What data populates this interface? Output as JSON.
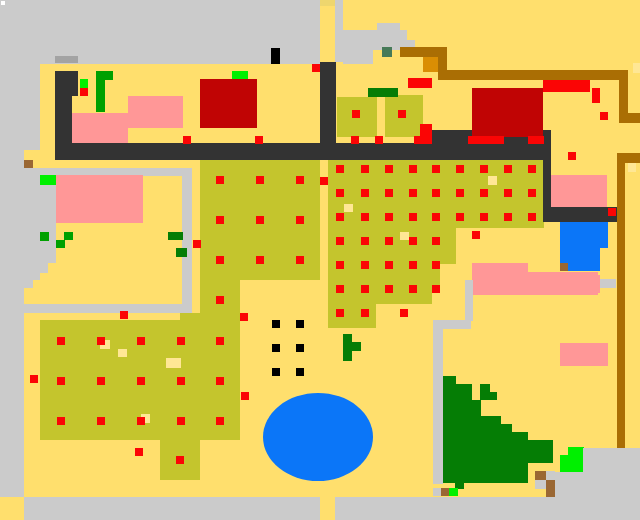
{
  "scene": {
    "label": "pixel-art overhead farm map",
    "width": 640,
    "height": 520
  },
  "palette": {
    "bg": "#ffdf6d",
    "plaza": "#cbcbcb",
    "btn": "#a3a3a3",
    "paledull": "#eed66e",
    "palebright": "#ffe795",
    "olive": "#c4c52d",
    "wall": "#333333",
    "red": "#fb0505",
    "darkred": "#c00404",
    "pink": "#ff9797",
    "blue": "#0b76f8",
    "brownline": "#aa6e04",
    "orange": "#da8e04",
    "brown": "#9a6733",
    "teal": "#477a58",
    "lime": "#00f000",
    "green": "#00a000",
    "darkgreen": "#057d05",
    "black": "#000000",
    "white": "#ffffff"
  },
  "shapes": [
    [
      "r",
      "plaza",
      0,
      0,
      320,
      64
    ],
    [
      "r",
      "plaza",
      0,
      64,
      40,
      86
    ],
    [
      "r",
      "plaza",
      0,
      150,
      24,
      347
    ],
    [
      "r",
      "plaza",
      335,
      0,
      8,
      62
    ],
    [
      "r",
      "plaza",
      377,
      23,
      23,
      9
    ],
    [
      "r",
      "plaza",
      343,
      30,
      64,
      10
    ],
    [
      "r",
      "plaza",
      343,
      40,
      72,
      10
    ],
    [
      "r",
      "plaza",
      343,
      50,
      30,
      14
    ],
    [
      "r",
      "paledull",
      320,
      0,
      15,
      6
    ],
    [
      "r",
      "white",
      1,
      1,
      4,
      4
    ],
    [
      "r",
      "btn",
      55,
      56,
      23,
      7
    ],
    [
      "r",
      "black",
      271,
      48,
      9,
      16
    ],
    [
      "r",
      "plaza",
      24,
      168,
      159,
      8
    ],
    [
      "r",
      "plaza",
      182,
      168,
      10,
      145
    ],
    [
      "r",
      "plaza",
      24,
      304,
      168,
      9
    ],
    [
      "r",
      "plaza",
      24,
      175,
      32,
      88
    ],
    [
      "r",
      "plaza",
      24,
      263,
      24,
      10
    ],
    [
      "r",
      "plaza",
      24,
      273,
      16,
      7
    ],
    [
      "r",
      "plaza",
      24,
      280,
      9,
      8
    ],
    [
      "r",
      "olive",
      200,
      160,
      120,
      120
    ],
    [
      "r",
      "olive",
      200,
      280,
      40,
      160
    ],
    [
      "r",
      "olive",
      40,
      320,
      192,
      120
    ],
    [
      "r",
      "olive",
      180,
      313,
      20,
      10
    ],
    [
      "r",
      "olive",
      160,
      440,
      40,
      40
    ],
    [
      "r",
      "olive",
      328,
      160,
      92,
      144
    ],
    [
      "r",
      "olive",
      328,
      304,
      48,
      24
    ],
    [
      "r",
      "olive",
      420,
      160,
      124,
      68
    ],
    [
      "r",
      "olive",
      420,
      228,
      36,
      36
    ],
    [
      "r",
      "olive",
      420,
      264,
      20,
      24
    ],
    [
      "r",
      "olive",
      420,
      288,
      12,
      16
    ],
    [
      "r",
      "olive",
      337,
      97,
      40,
      40
    ],
    [
      "r",
      "olive",
      385,
      95,
      38,
      42
    ],
    [
      "r",
      "darkgreen",
      368,
      88,
      30,
      9
    ],
    [
      "r",
      "wall",
      55,
      71,
      23,
      25
    ],
    [
      "r",
      "wall",
      55,
      96,
      17,
      64
    ],
    [
      "r",
      "wall",
      55,
      143,
      377,
      17
    ],
    [
      "r",
      "wall",
      432,
      130,
      119,
      30
    ],
    [
      "r",
      "wall",
      320,
      62,
      16,
      98
    ],
    [
      "r",
      "wall",
      543,
      160,
      8,
      62
    ],
    [
      "r",
      "wall",
      551,
      207,
      66,
      15
    ],
    [
      "r",
      "darkred",
      200,
      79,
      57,
      49
    ],
    [
      "r",
      "darkred",
      472,
      88,
      71,
      49
    ],
    [
      "r",
      "lime",
      232,
      71,
      16,
      8
    ],
    [
      "r",
      "pink",
      128,
      96,
      55,
      32
    ],
    [
      "r",
      "pink",
      72,
      113,
      56,
      30
    ],
    [
      "r",
      "pink",
      56,
      175,
      87,
      48
    ],
    [
      "r",
      "pink",
      551,
      175,
      56,
      32
    ],
    [
      "r",
      "pink",
      560,
      275,
      40,
      18
    ],
    [
      "r",
      "pink",
      560,
      343,
      48,
      23
    ],
    [
      "r",
      "pink",
      472,
      263,
      56,
      9
    ],
    [
      "r",
      "pink",
      472,
      272,
      126,
      23
    ],
    [
      "r",
      "plaza",
      600,
      279,
      16,
      9
    ],
    [
      "r",
      "brownline",
      400,
      47,
      47,
      10
    ],
    [
      "r",
      "brownline",
      438,
      48,
      9,
      27
    ],
    [
      "r",
      "brownline",
      438,
      70,
      190,
      10
    ],
    [
      "r",
      "brownline",
      619,
      73,
      9,
      50
    ],
    [
      "r",
      "brownline",
      628,
      113,
      12,
      10
    ],
    [
      "r",
      "brownline",
      617,
      153,
      23,
      10
    ],
    [
      "r",
      "brownline",
      617,
      163,
      8,
      285
    ],
    [
      "r",
      "orange",
      423,
      57,
      15,
      15
    ],
    [
      "r",
      "teal",
      382,
      47,
      10,
      10
    ],
    [
      "r",
      "palebright",
      633,
      63,
      7,
      10
    ],
    [
      "r",
      "palebright",
      628,
      163,
      8,
      9
    ],
    [
      "r",
      "lime",
      80,
      79,
      8,
      9
    ],
    [
      "r",
      "green",
      96,
      71,
      17,
      9
    ],
    [
      "r",
      "green",
      96,
      80,
      9,
      24
    ],
    [
      "r",
      "green",
      96,
      103,
      9,
      9
    ],
    [
      "r",
      "lime",
      40,
      175,
      16,
      10
    ],
    [
      "r",
      "green",
      40,
      232,
      9,
      9
    ],
    [
      "r",
      "green",
      64,
      232,
      9,
      8
    ],
    [
      "r",
      "green",
      56,
      240,
      9,
      8
    ],
    [
      "r",
      "darkgreen",
      168,
      232,
      15,
      8
    ],
    [
      "r",
      "darkgreen",
      176,
      248,
      11,
      9
    ],
    [
      "r",
      "brown",
      24,
      160,
      9,
      8
    ],
    [
      "e",
      "blue",
      318,
      437,
      55,
      44
    ],
    [
      "r",
      "blue",
      560,
      222,
      48,
      26
    ],
    [
      "r",
      "blue",
      560,
      248,
      40,
      23
    ],
    [
      "r",
      "brown",
      560,
      263,
      8,
      8
    ],
    [
      "r",
      "darkgreen",
      343,
      334,
      9,
      27
    ],
    [
      "r",
      "darkgreen",
      352,
      342,
      9,
      9
    ],
    [
      "r",
      "darkgreen",
      441,
      376,
      15,
      9
    ],
    [
      "r",
      "darkgreen",
      441,
      384,
      31,
      16
    ],
    [
      "r",
      "darkgreen",
      480,
      384,
      10,
      16
    ],
    [
      "r",
      "darkgreen",
      488,
      392,
      9,
      8
    ],
    [
      "r",
      "darkgreen",
      441,
      400,
      40,
      16
    ],
    [
      "r",
      "darkgreen",
      441,
      416,
      60,
      9
    ],
    [
      "r",
      "darkgreen",
      441,
      424,
      71,
      8
    ],
    [
      "r",
      "darkgreen",
      441,
      432,
      87,
      9
    ],
    [
      "r",
      "darkgreen",
      441,
      440,
      112,
      23
    ],
    [
      "r",
      "darkgreen",
      441,
      463,
      87,
      20
    ],
    [
      "r",
      "darkgreen",
      455,
      480,
      9,
      9
    ],
    [
      "r",
      "lime",
      568,
      447,
      16,
      9
    ],
    [
      "r",
      "lime",
      560,
      455,
      24,
      17
    ],
    [
      "r",
      "plaza",
      583,
      448,
      57,
      26
    ],
    [
      "r",
      "plaza",
      551,
      472,
      89,
      25
    ],
    [
      "r",
      "plaza",
      465,
      280,
      8,
      41
    ],
    [
      "r",
      "plaza",
      433,
      320,
      38,
      9
    ],
    [
      "r",
      "plaza",
      433,
      329,
      10,
      155
    ],
    [
      "r",
      "plaza",
      433,
      488,
      8,
      8
    ],
    [
      "r",
      "brown",
      441,
      488,
      8,
      8
    ],
    [
      "r",
      "lime",
      449,
      488,
      9,
      8
    ],
    [
      "r",
      "brown",
      535,
      471,
      12,
      9
    ],
    [
      "r",
      "plaza",
      546,
      471,
      9,
      9
    ],
    [
      "r",
      "plaza",
      535,
      480,
      11,
      9
    ],
    [
      "r",
      "brown",
      546,
      480,
      9,
      17
    ],
    [
      "r",
      "plaza",
      24,
      497,
      616,
      23
    ],
    [
      "r",
      "bg",
      320,
      497,
      15,
      23
    ],
    [
      "r",
      "palebright",
      100,
      340,
      10,
      9
    ],
    [
      "r",
      "palebright",
      118,
      349,
      9,
      8
    ],
    [
      "r",
      "palebright",
      166,
      358,
      15,
      10
    ],
    [
      "r",
      "palebright",
      141,
      414,
      9,
      9
    ],
    [
      "r",
      "palebright",
      344,
      204,
      9,
      8
    ],
    [
      "r",
      "palebright",
      400,
      232,
      9,
      8
    ],
    [
      "r",
      "palebright",
      488,
      176,
      9,
      9
    ],
    [
      "r",
      "red",
      468,
      136,
      36,
      8
    ],
    [
      "r",
      "red",
      528,
      136,
      16,
      8
    ],
    [
      "r",
      "red",
      543,
      80,
      47,
      12
    ],
    [
      "r",
      "red",
      408,
      78,
      24,
      10
    ],
    [
      "r",
      "red",
      420,
      124,
      12,
      12
    ],
    [
      "r",
      "red",
      414,
      136,
      18,
      8
    ],
    [
      "r",
      "red",
      592,
      88,
      8,
      15
    ]
  ],
  "dot_grids": [
    {
      "c": "red",
      "xs": [
        216,
        256,
        296
      ],
      "ys": [
        176,
        216,
        256
      ],
      "w": 8,
      "h": 8
    },
    {
      "c": "red",
      "xs": [
        216
      ],
      "ys": [
        296,
        337,
        377,
        417
      ],
      "w": 8,
      "h": 8
    },
    {
      "c": "red",
      "xs": [
        336,
        361,
        385,
        409
      ],
      "ys": [
        165,
        189,
        213,
        237,
        261,
        285
      ],
      "w": 8,
      "h": 8
    },
    {
      "c": "red",
      "xs": [
        336,
        361
      ],
      "ys": [
        309
      ],
      "w": 8,
      "h": 8
    },
    {
      "c": "red",
      "xs": [
        432,
        456,
        480,
        504,
        528
      ],
      "ys": [
        165,
        189,
        213
      ],
      "w": 8,
      "h": 8
    },
    {
      "c": "red",
      "xs": [
        432
      ],
      "ys": [
        237,
        261,
        285
      ],
      "w": 8,
      "h": 8
    },
    {
      "c": "red",
      "xs": [
        57,
        97,
        137,
        177
      ],
      "ys": [
        337,
        377,
        417
      ],
      "w": 8,
      "h": 8
    },
    {
      "c": "black",
      "xs": [
        272,
        296
      ],
      "ys": [
        320,
        344,
        368
      ],
      "w": 8,
      "h": 8
    }
  ],
  "points": [
    {
      "c": "red",
      "x": 320,
      "y": 177
    },
    {
      "c": "red",
      "x": 400,
      "y": 309
    },
    {
      "c": "red",
      "x": 472,
      "y": 231
    },
    {
      "c": "red",
      "x": 240,
      "y": 313
    },
    {
      "c": "red",
      "x": 241,
      "y": 392
    },
    {
      "c": "red",
      "x": 30,
      "y": 375
    },
    {
      "c": "red",
      "x": 135,
      "y": 448
    },
    {
      "c": "red",
      "x": 176,
      "y": 456
    },
    {
      "c": "red",
      "x": 193,
      "y": 240
    },
    {
      "c": "red",
      "x": 120,
      "y": 311
    },
    {
      "c": "red",
      "x": 312,
      "y": 64
    },
    {
      "c": "red",
      "x": 183,
      "y": 136
    },
    {
      "c": "red",
      "x": 255,
      "y": 136
    },
    {
      "c": "red",
      "x": 351,
      "y": 136
    },
    {
      "c": "red",
      "x": 375,
      "y": 136
    },
    {
      "c": "red",
      "x": 352,
      "y": 110
    },
    {
      "c": "red",
      "x": 398,
      "y": 110
    },
    {
      "c": "red",
      "x": 80,
      "y": 88
    },
    {
      "c": "red",
      "x": 568,
      "y": 152
    },
    {
      "c": "red",
      "x": 600,
      "y": 112
    },
    {
      "c": "red",
      "x": 608,
      "y": 208
    }
  ]
}
